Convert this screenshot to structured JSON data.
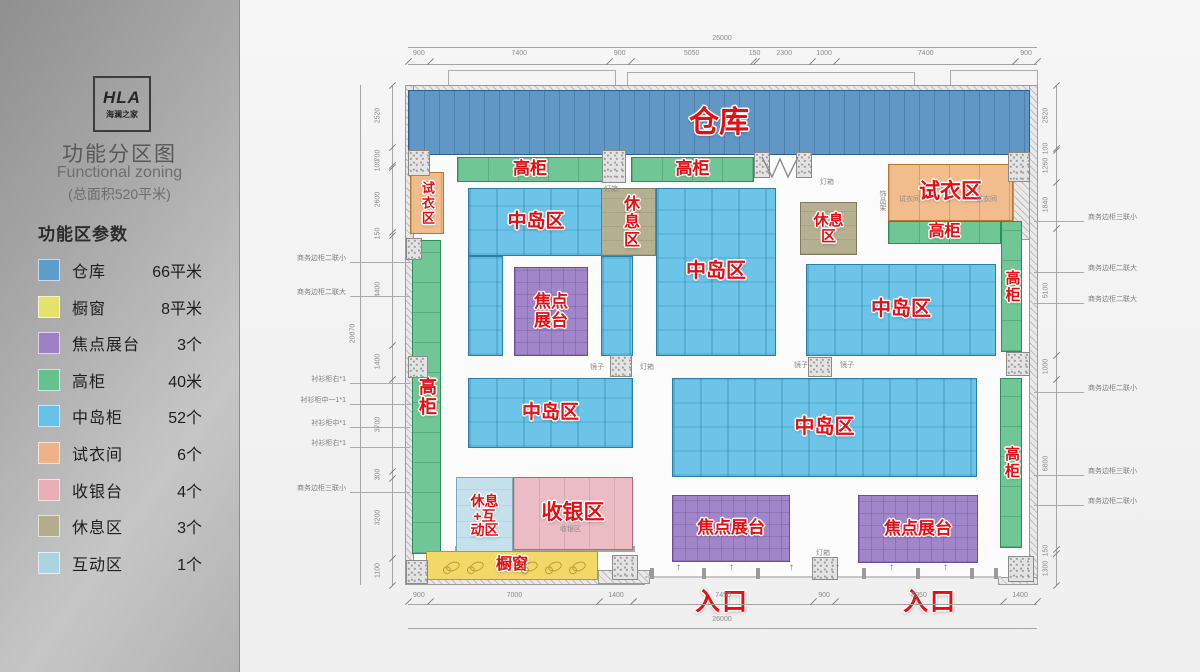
{
  "sidebar": {
    "logo": {
      "line1": "HLA",
      "line2": "海澜之家"
    },
    "title": "功能分区图",
    "subtitle": "Functional zoning",
    "subtitle2": "(总面积520平米)",
    "params_heading": "功能区参数",
    "legend": [
      {
        "label": "仓库",
        "value": "66平米",
        "color": "#5d9dcc"
      },
      {
        "label": "橱窗",
        "value": "8平米",
        "color": "#e5e26b"
      },
      {
        "label": "焦点展台",
        "value": "3个",
        "color": "#9c81c4"
      },
      {
        "label": "高柜",
        "value": "40米",
        "color": "#63c28e"
      },
      {
        "label": "中岛柜",
        "value": "52个",
        "color": "#66c1e8"
      },
      {
        "label": "试衣间",
        "value": "6个",
        "color": "#edb286"
      },
      {
        "label": "收银台",
        "value": "4个",
        "color": "#e9aeb8"
      },
      {
        "label": "休息区",
        "value": "3个",
        "color": "#b2ad8b"
      },
      {
        "label": "互动区",
        "value": "1个",
        "color": "#abd4e3"
      }
    ]
  },
  "plan": {
    "zones": [
      {
        "id": "warehouse",
        "label": "仓库",
        "type": "warehouse",
        "x": 408,
        "y": 90,
        "w": 622,
        "h": 65,
        "fs": 30
      },
      {
        "id": "cabinet-top-left",
        "label": "高柜",
        "type": "cabinet",
        "x": 457,
        "y": 157,
        "w": 146,
        "h": 25,
        "fs": 17
      },
      {
        "id": "cabinet-top-right",
        "label": "高柜",
        "type": "cabinet",
        "x": 631,
        "y": 157,
        "w": 123,
        "h": 25,
        "fs": 17
      },
      {
        "id": "fitting-left",
        "label": "试衣区",
        "type": "fitting",
        "x": 410,
        "y": 172,
        "w": 34,
        "h": 62,
        "fs": 13,
        "orient": "v"
      },
      {
        "id": "fitting-right",
        "label": "试衣区",
        "type": "fitting",
        "x": 888,
        "y": 164,
        "w": 125,
        "h": 57,
        "fs": 21
      },
      {
        "id": "cabinet-right-h",
        "label": "高柜",
        "type": "cabinet",
        "x": 888,
        "y": 221,
        "w": 113,
        "h": 23,
        "fs": 16
      },
      {
        "id": "cabinet-right-v1",
        "label": "高柜",
        "type": "cabinet",
        "x": 1001,
        "y": 221,
        "w": 21,
        "h": 131,
        "fs": 15,
        "orient": "v"
      },
      {
        "id": "cabinet-left-v",
        "label": "高柜",
        "type": "cabinet",
        "x": 412,
        "y": 240,
        "w": 29,
        "h": 314,
        "fs": 18,
        "orient": "v"
      },
      {
        "id": "cabinet-right-v2",
        "label": "高柜",
        "type": "cabinet",
        "x": 1000,
        "y": 378,
        "w": 22,
        "h": 170,
        "fs": 15,
        "orient": "v"
      },
      {
        "id": "island-1",
        "label": "中岛区",
        "type": "island",
        "x": 468,
        "y": 188,
        "w": 136,
        "h": 68,
        "fs": 19
      },
      {
        "id": "island-1-left",
        "label": "",
        "type": "island",
        "x": 468,
        "y": 256,
        "w": 35,
        "h": 100
      },
      {
        "id": "island-1-right",
        "label": "",
        "type": "island",
        "x": 601,
        "y": 256,
        "w": 32,
        "h": 100
      },
      {
        "id": "focal-1",
        "label": "焦点展台",
        "type": "focal",
        "x": 514,
        "y": 267,
        "w": 74,
        "h": 89,
        "fs": 17,
        "wrap": true
      },
      {
        "id": "rest-1",
        "label": "休息区",
        "type": "rest",
        "x": 601,
        "y": 188,
        "w": 55,
        "h": 68,
        "fs": 16,
        "orient": "v"
      },
      {
        "id": "island-2",
        "label": "中岛区",
        "type": "island",
        "x": 656,
        "y": 188,
        "w": 120,
        "h": 168,
        "fs": 20
      },
      {
        "id": "rest-2",
        "label": "休息区",
        "type": "rest",
        "x": 800,
        "y": 202,
        "w": 57,
        "h": 53,
        "fs": 15,
        "wrap": true
      },
      {
        "id": "island-3",
        "label": "中岛区",
        "type": "island",
        "x": 806,
        "y": 264,
        "w": 190,
        "h": 92,
        "fs": 20
      },
      {
        "id": "island-4",
        "label": "中岛区",
        "type": "island",
        "x": 468,
        "y": 378,
        "w": 165,
        "h": 70,
        "fs": 19
      },
      {
        "id": "island-5",
        "label": "中岛区",
        "type": "island",
        "x": 672,
        "y": 378,
        "w": 305,
        "h": 99,
        "fs": 20
      },
      {
        "id": "rest-interactive",
        "label": "休息+互动区",
        "type": "interactive",
        "x": 456,
        "y": 477,
        "w": 57,
        "h": 78,
        "fs": 14,
        "wrap": true
      },
      {
        "id": "cashier",
        "label": "收银区",
        "type": "cashier",
        "x": 513,
        "y": 477,
        "w": 120,
        "h": 73,
        "fs": 21
      },
      {
        "id": "window-display",
        "label": "橱窗",
        "type": "window",
        "x": 426,
        "y": 551,
        "w": 172,
        "h": 29,
        "fs": 16
      },
      {
        "id": "focal-2",
        "label": "焦点展台",
        "type": "focal",
        "x": 672,
        "y": 495,
        "w": 118,
        "h": 67,
        "fs": 17
      },
      {
        "id": "focal-3",
        "label": "焦点展台",
        "type": "focal",
        "x": 858,
        "y": 495,
        "w": 120,
        "h": 68,
        "fs": 17
      }
    ],
    "entrances": [
      {
        "label": "入口",
        "x": 695,
        "y": 582
      },
      {
        "label": "入口",
        "x": 903,
        "y": 582
      }
    ],
    "dimensions": {
      "top_total": "26000",
      "bottom_total": "26000",
      "left_total": "20070",
      "top": [
        900,
        7400,
        900,
        5050,
        150,
        2300,
        1000,
        7400,
        900
      ],
      "bottom": [
        900,
        7000,
        1400,
        7450,
        900,
        6950,
        1400
      ],
      "left": [
        2520,
        700,
        100,
        2600,
        150,
        4400,
        1400,
        3700,
        300,
        3200,
        1100
      ],
      "right": [
        2520,
        100,
        1260,
        1840,
        5100,
        1000,
        6800,
        150,
        1300
      ]
    },
    "left_leaders": [
      {
        "y": 262,
        "text": "商务边柜二联小"
      },
      {
        "y": 296,
        "text": "商务边柜二联大"
      },
      {
        "y": 383,
        "text": "衬衫柜右*1"
      },
      {
        "y": 404,
        "text": "衬衫柜中一1*1"
      },
      {
        "y": 427,
        "text": "衬衫柜中*1"
      },
      {
        "y": 447,
        "text": "衬衫柜右*1"
      },
      {
        "y": 492,
        "text": "商务边柜三联小"
      }
    ],
    "right_leaders": [
      {
        "y": 221,
        "text": "商务边柜三联小"
      },
      {
        "y": 272,
        "text": "商务边柜二联大"
      },
      {
        "y": 303,
        "text": "商务边柜二联大"
      },
      {
        "y": 392,
        "text": "商务边柜二联小"
      },
      {
        "y": 475,
        "text": "商务边柜三联小"
      },
      {
        "y": 505,
        "text": "商务边柜二联小"
      }
    ],
    "small_labels": [
      {
        "x": 604,
        "y": 184,
        "text": "灯箱"
      },
      {
        "x": 820,
        "y": 177,
        "text": "灯箱"
      },
      {
        "x": 590,
        "y": 362,
        "text": "镜子"
      },
      {
        "x": 640,
        "y": 362,
        "text": "灯箱"
      },
      {
        "x": 794,
        "y": 360,
        "text": "镜子"
      },
      {
        "x": 840,
        "y": 360,
        "text": "镜子"
      },
      {
        "x": 816,
        "y": 548,
        "text": "灯箱"
      },
      {
        "x": 877,
        "y": 190,
        "text": "饰品架",
        "orient": "v"
      },
      {
        "x": 899,
        "y": 194,
        "text": "试衣间"
      },
      {
        "x": 976,
        "y": 194,
        "text": "试衣间"
      },
      {
        "x": 560,
        "y": 524,
        "text": "收银区"
      }
    ]
  }
}
